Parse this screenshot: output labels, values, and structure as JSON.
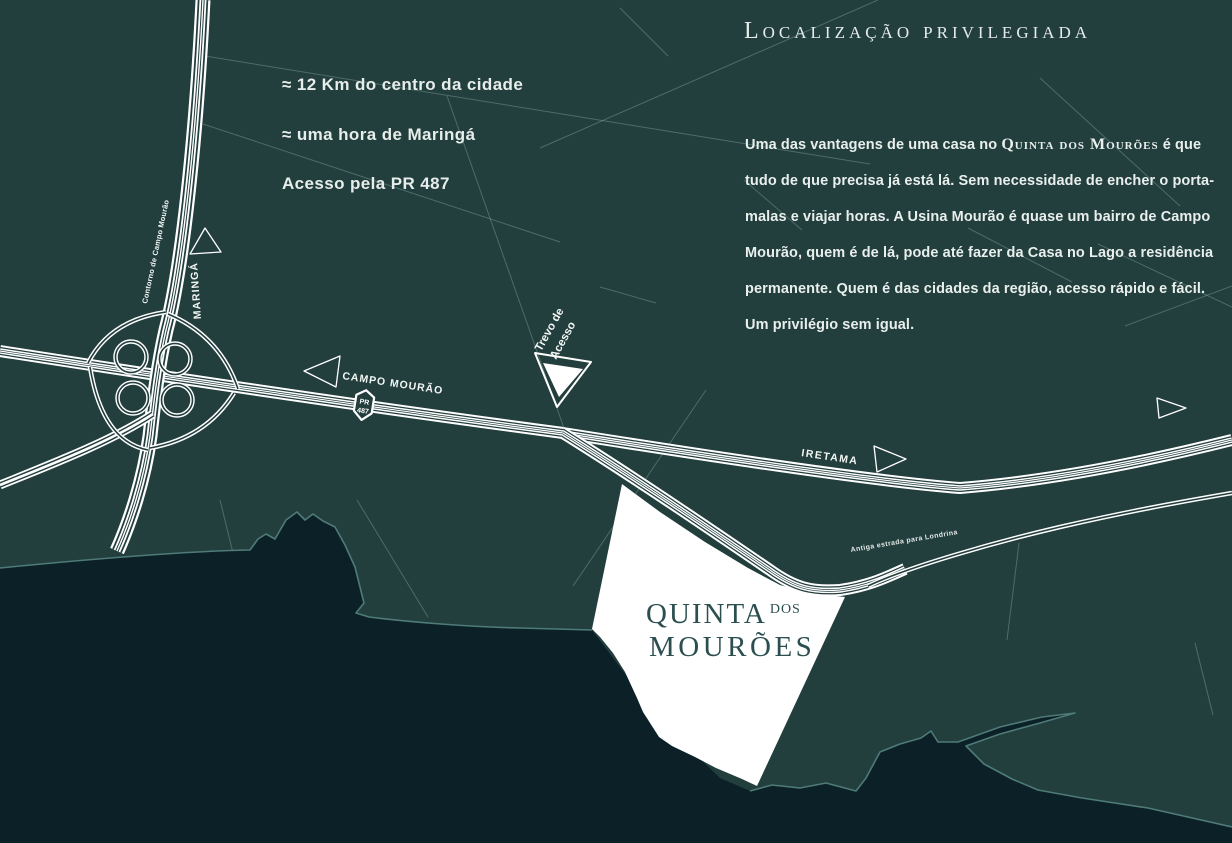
{
  "header": {
    "title": "Localização privilegiada"
  },
  "info": {
    "items": [
      "≈ 12 Km do centro da cidade",
      "≈ uma hora de Maringá",
      "Acesso pela PR 487"
    ]
  },
  "paragraph": {
    "intro": "Uma das vantagens de uma casa no ",
    "brand": "Quinta dos Mourões",
    "rest": " é que tudo de que precisa já está lá. Sem necessidade de encher o porta-malas e viajar horas. A Usina Mourão é quase um bairro de Campo Mourão, quem é de lá, pode até fazer da Casa no Lago a residência permanente. Quem é das cidades da região, acesso rápido e fácil. Um privilégio sem igual."
  },
  "map": {
    "road_labels": {
      "campo_mourao": "CAMPO MOURÃO",
      "maringa": "MARINGÁ",
      "contorno": "Contorno de Campo Mourão",
      "trevo_line1": "Trevo de",
      "trevo_line2": "Acesso",
      "iretama": "IRETAMA",
      "antiga": "Antiga estrada para Londrina",
      "shield_line1": "PR",
      "shield_line2": "487"
    },
    "logo": {
      "top_word": "QUINTA",
      "top_suffix": "DOS",
      "bottom_word": "MOURÕES"
    }
  },
  "colors": {
    "background": "#223E3D",
    "water": "#0C2127",
    "coast_outline": "#4E7B78",
    "road": "#FFFFFF",
    "text": "#E8EFEC",
    "logo_text": "#2B4E4F"
  }
}
